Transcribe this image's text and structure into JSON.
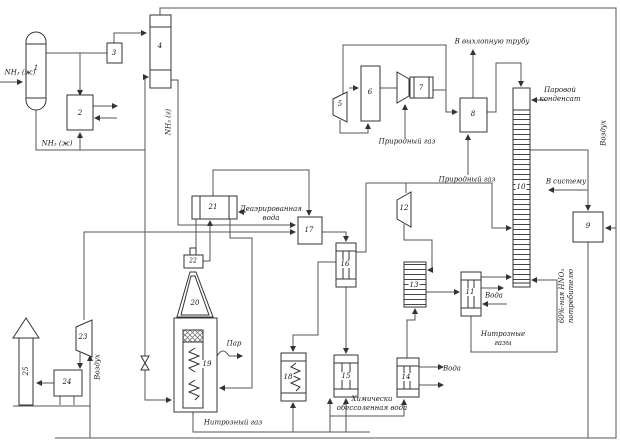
{
  "diagram_type": "process-flow-diagram",
  "equipment": {
    "e1": "1",
    "e2": "2",
    "e3": "3",
    "e4": "4",
    "e5": "5",
    "e6": "6",
    "e7": "7",
    "e8": "8",
    "e9": "9",
    "e10": "10",
    "e11": "11",
    "e12": "12",
    "e13": "13",
    "e14": "14",
    "e15": "15",
    "e16": "16",
    "e17": "17",
    "e18": "18",
    "e19": "19",
    "e20": "20",
    "e21": "21",
    "e22": "22",
    "e23": "23",
    "e24": "24",
    "e25": "25"
  },
  "labels": {
    "nh3_liquid": "NH₃ (ж)",
    "nh3_gas": "NH₃ (г)",
    "natural_gas": "Природный газ",
    "exhaust": "В выхлопную трубу",
    "steam_condensate_1": "Паровой",
    "steam_condensate_2": "конденсат",
    "air": "Воздух",
    "to_system": "В систему",
    "acid_1": "60%-ная HNO₃",
    "acid_2": "потребителю",
    "water": "Вода",
    "nitrous_gases_1": "Нитрозные",
    "nitrous_gases_2": "газы",
    "deaerated_1": "Деаэрированная",
    "deaerated_2": "вода",
    "steam": "Пар",
    "nitrous_gas": "Нитрозный газ",
    "demi_water_1": "Химически",
    "demi_water_2": "обессоленная вода"
  },
  "colors": {
    "background": "#ffffff",
    "pipe": "#555555",
    "outline": "#333333",
    "text": "#1a1a1a"
  }
}
